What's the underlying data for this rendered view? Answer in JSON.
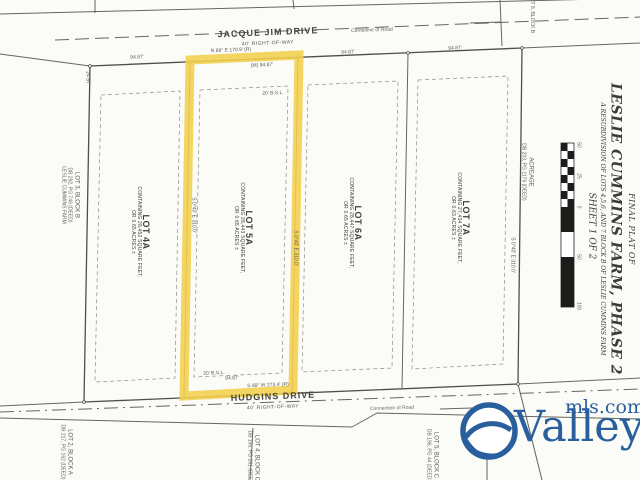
{
  "page": {
    "background": "#fbfbf8",
    "ink": "#55554e",
    "highlight_color": "#f3cf4b"
  },
  "roads": {
    "top": {
      "name": "JACQUE JIM DRIVE",
      "right_of_way": "40' RIGHT-OF-WAY",
      "note": "Centerline of Road"
    },
    "bottom": {
      "name": "HUDGINS DRIVE",
      "right_of_way": "40' RIGHT-OF-WAY",
      "note": "Connection of Road"
    }
  },
  "lots": [
    {
      "name": "LOT 4A",
      "line1": "CONTAINING 28,452 SQUARE FEET,",
      "line2": "OR 0.65 ACRES ±",
      "highlighted": false
    },
    {
      "name": "LOT 5A",
      "line1": "CONTAINING 28,443 SQUARE FEET,",
      "line2": "OR 0.65 ACRES ±",
      "highlighted": true
    },
    {
      "name": "LOT 6A",
      "line1": "CONTAINING 28,447 SQUARE FEET,",
      "line2": "OR 0.65 ACRES ±",
      "highlighted": false
    },
    {
      "name": "LOT 7A",
      "line1": "CONTAINING 27,434 SQUARE FEET,",
      "line2": "OR 0.63 ACRES ±",
      "highlighted": false
    }
  ],
  "dimensions": {
    "top_lot4a": "94.87'",
    "top_lot5a_record": "N 89° E 170.9' (R)",
    "top_lot5a_measured": "(M) 94.87'",
    "top_lot6a": "94.87'",
    "top_lot7a": "94.87'",
    "bottom_lot5a_record": "S 89° W 273.4' (R)",
    "bottom_lot5a_len": "94.87'",
    "setback_top": "20' B.S.L.",
    "setback_bottom": "20' B.S.L.",
    "side_bearing_left": "S 0°40' E 310.0'",
    "side_bearing_right": "S 0°40' E 310.0'",
    "side_bearing_east": "S 0°40' E 310.0'",
    "west_edge_tick": "24.97'"
  },
  "adjacent_parcels": {
    "west": {
      "name": "LOT 3, BLOCK B",
      "deed": "DB 292, PG 746 (DEED)",
      "extra": "LESLIE CUMMINS FARM"
    },
    "southwest": {
      "name": "LOT 2, BLOCK A",
      "deed": "DB 217, PG 162 (DEED)"
    },
    "south_mid": {
      "name": "LOT 4, BLOCK C",
      "deed": "DB 195, PG 281 (DEED)"
    },
    "south_east": {
      "name": "LOT 5, BLOCK C",
      "deed": "DB 196, PG 44 (DEED)"
    },
    "east": {
      "name": "ACREAGE",
      "deed": "DB 203, PG 1179 (DEED)"
    },
    "northeast": {
      "name": "LOT 8, BLOCK B"
    }
  },
  "title_block": {
    "line1": "FINAL PLAT OF",
    "line2": "LESLIE CUMMINS FARM, PHASE 2",
    "line3": "A RESUBDIVISION OF LOTS 4,5,6, AND 7 BLOCK B OF LESLIE CUMMINS FARM",
    "line4": "SHEET 1 OF 2"
  },
  "scale_bar": {
    "ticks": [
      "50",
      "25",
      "0",
      "50",
      "100"
    ]
  },
  "logo": {
    "brand": "Valley",
    "suffix": "mls.com",
    "color": "#2a5f9e"
  }
}
